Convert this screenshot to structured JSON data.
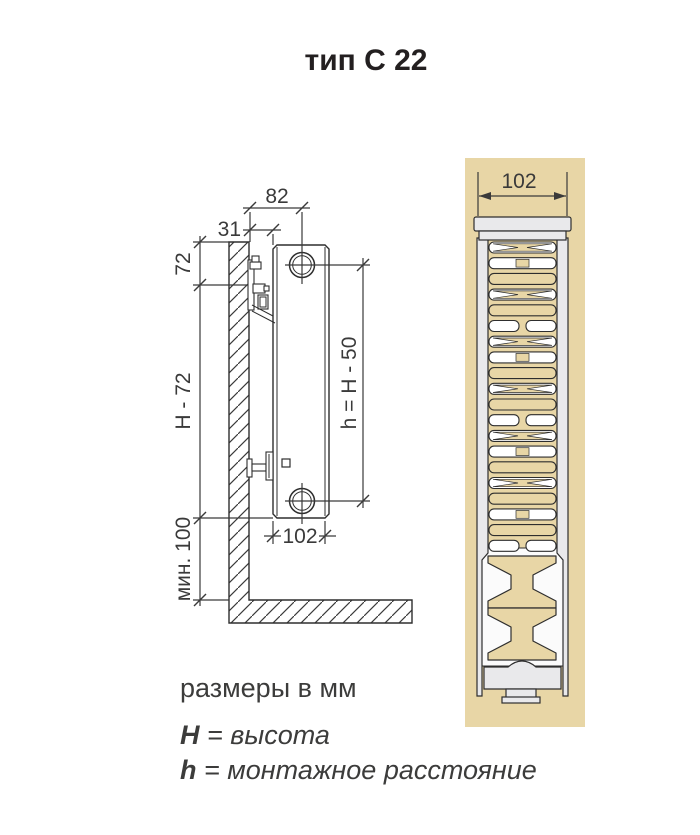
{
  "title": "тип С 22",
  "side_view": {
    "dim_total_depth": "82",
    "dim_wall_gap": "31",
    "dim_top_offset": "72",
    "dim_height_minus": "H - 72",
    "dim_min_clearance": "мин. 100",
    "dim_mount_distance": "h = H - 50",
    "dim_body_depth": "102"
  },
  "cross_section": {
    "dim_depth": "102"
  },
  "legend": {
    "units_note": "размеры в мм",
    "height_def": {
      "symbol": "H",
      "rest": " = высота"
    },
    "mount_def": {
      "symbol": "h",
      "rest": " = монтажное расстояние"
    }
  },
  "colors": {
    "background": "#ffffff",
    "panel_tan": "#e8d6a6",
    "radiator_grey": "#e9e9eb",
    "line_dark": "#2e2e2e",
    "dim_line": "#3a3a3a",
    "text": "#3c3c3b"
  }
}
